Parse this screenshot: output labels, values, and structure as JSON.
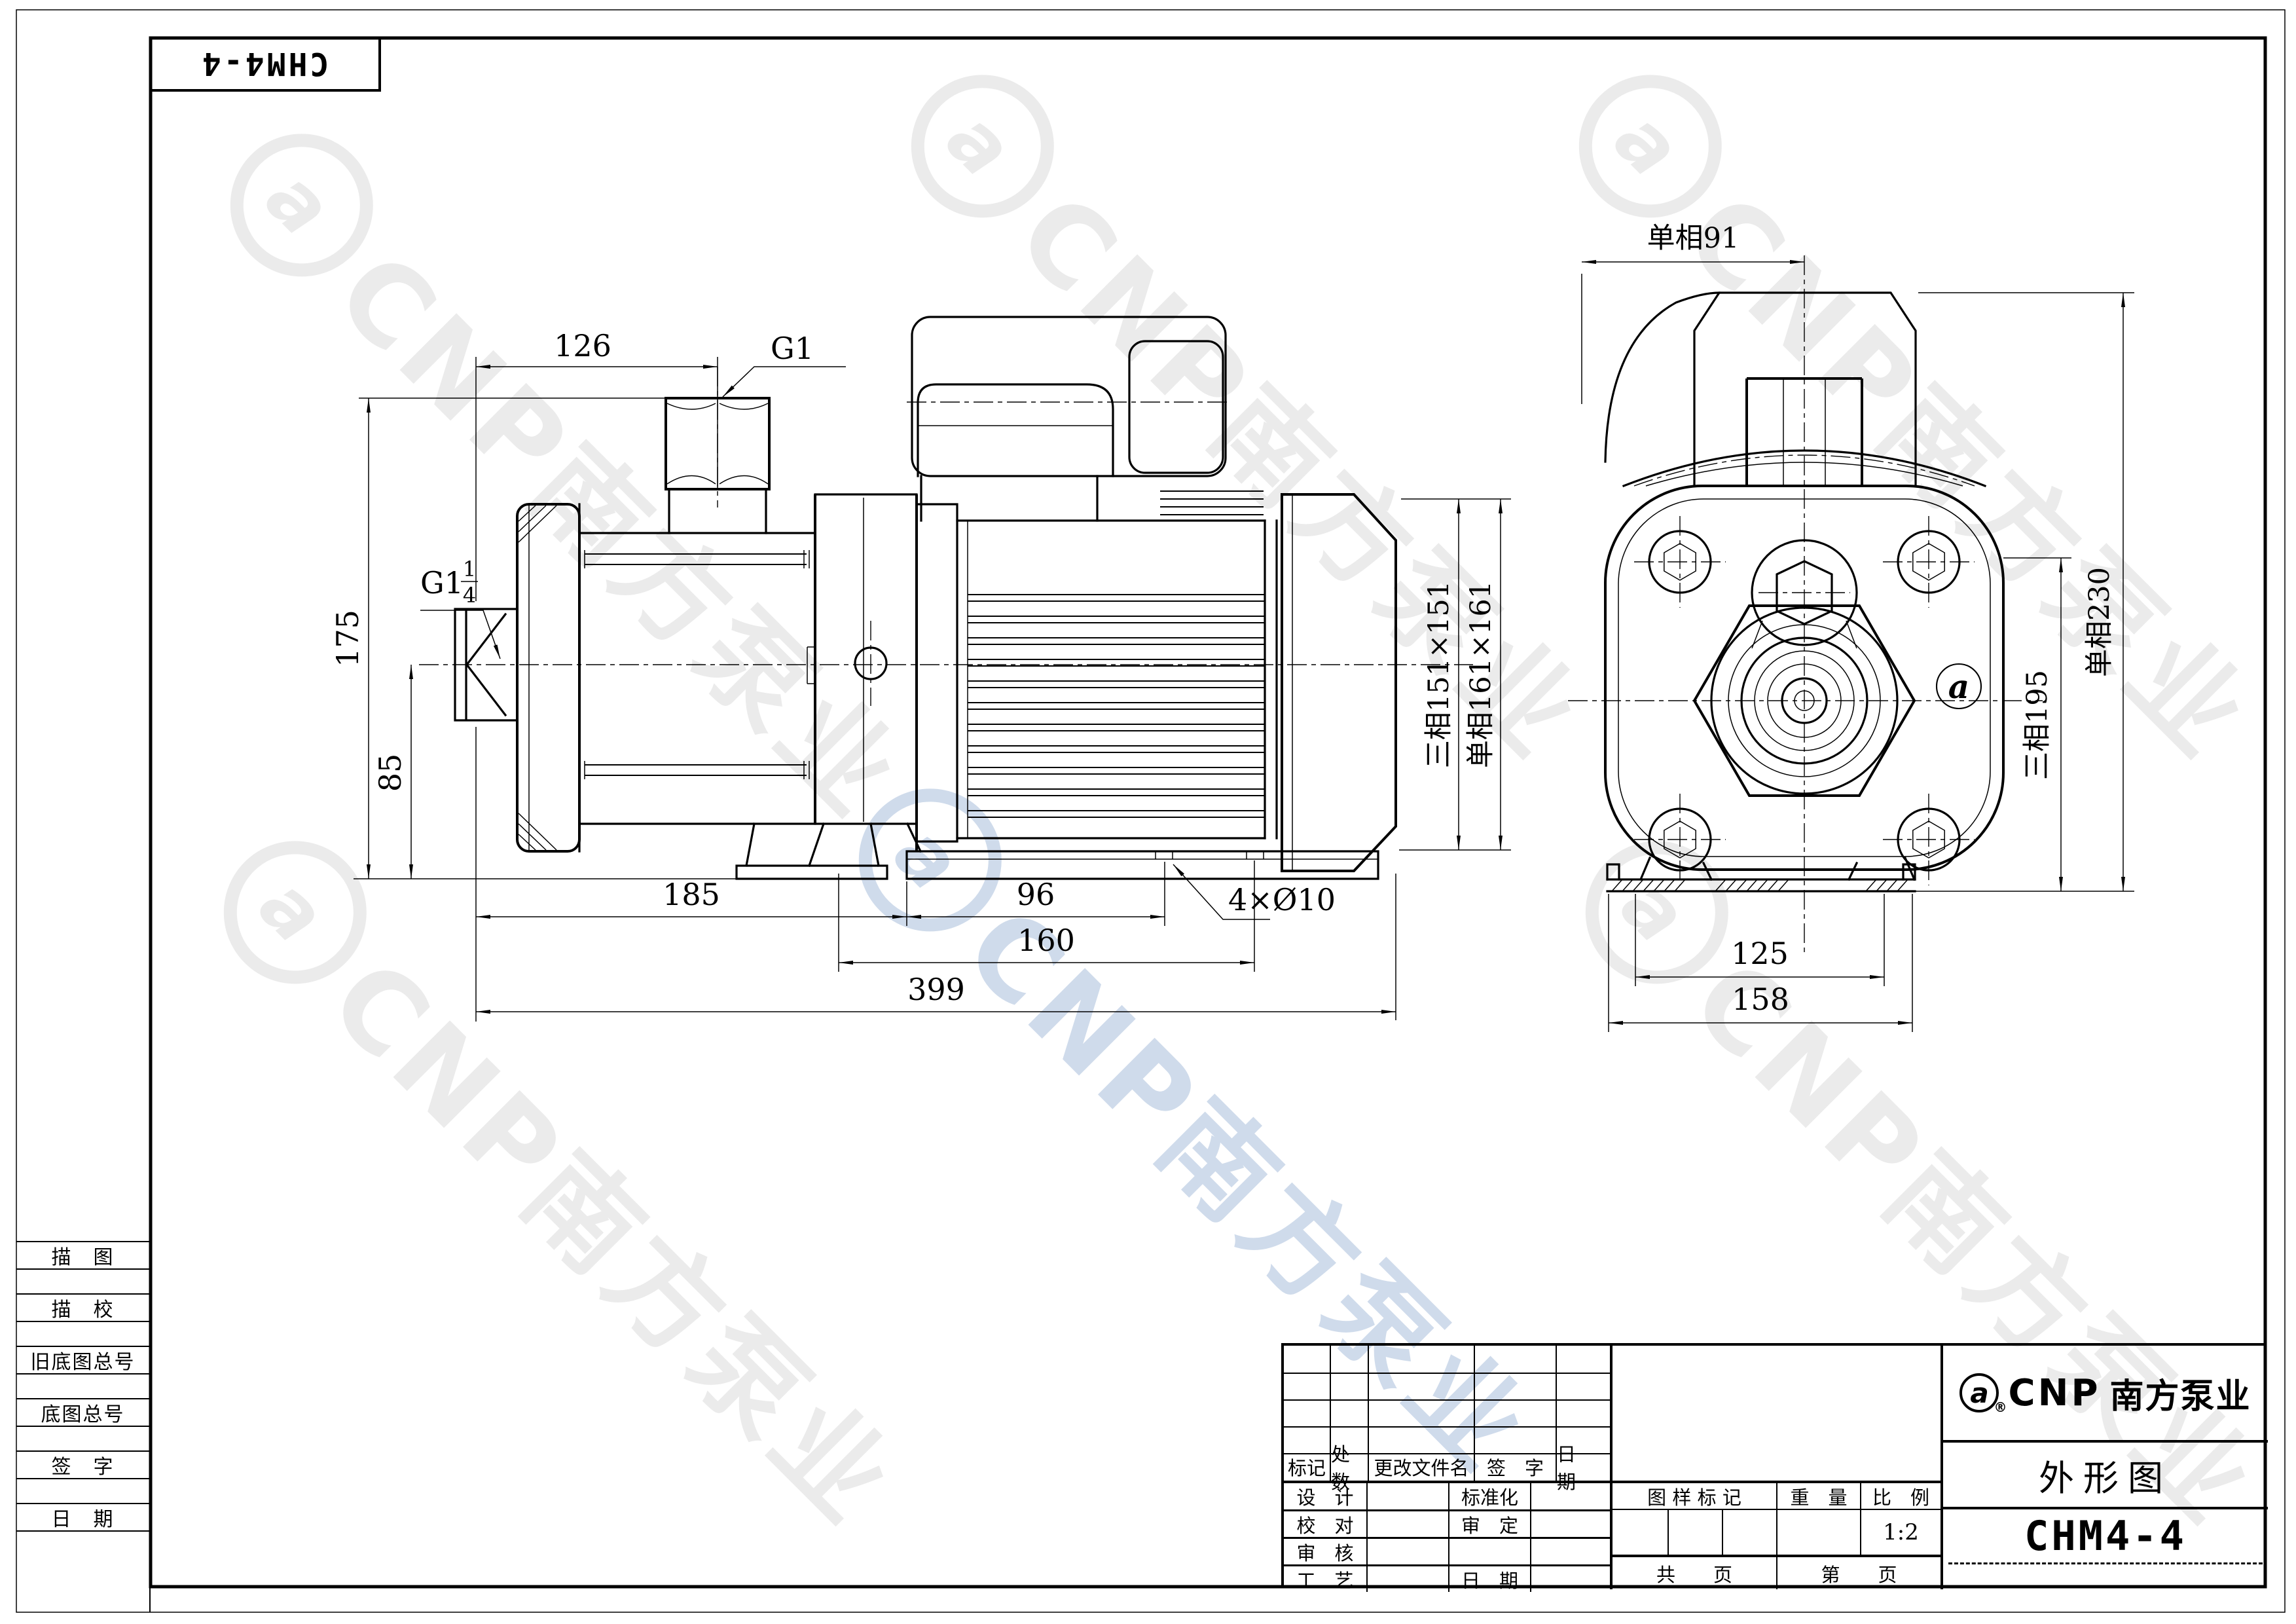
{
  "model": "CHM4-4",
  "watermark": {
    "logo_letter": "a",
    "text": "CNP南方泵业"
  },
  "left_strip": [
    "描　图",
    "描　校",
    "旧底图总号",
    "底图总号",
    "签　字",
    "日　期"
  ],
  "left_view": {
    "d126": "126",
    "g1": "G1",
    "gq_base": "G1",
    "gq_num": "1",
    "gq_den": "4",
    "d175": "175",
    "d85": "85",
    "d185": "185",
    "d96": "96",
    "d160": "160",
    "d399": "399",
    "holes": "4×Ø10",
    "ph3": "三相151×151",
    "ph1": "单相161×161"
  },
  "right_view": {
    "top": "单相91",
    "ph3": "三相195",
    "ph1": "单相230",
    "d125": "125",
    "d158": "158",
    "casing_logo": "a"
  },
  "title_block": {
    "revision_header": [
      "标记",
      "处数",
      "更改文件名",
      "签　字",
      "日　期"
    ],
    "rows": [
      {
        "l": "设　计",
        "r": "标准化"
      },
      {
        "l": "校　对",
        "r": "审　定"
      },
      {
        "l": "审　核",
        "r": ""
      },
      {
        "l": "工　艺",
        "r": "日　期"
      }
    ],
    "stamp_header": [
      "图 样 标 记",
      "重　量",
      "比　例"
    ],
    "scale_value": "1:2",
    "pages_total": "共　　页",
    "pages_no": "第　　页",
    "brand": {
      "logo_letter": "a",
      "reg": "®",
      "cnp": "CNP",
      "name": "南方泵业"
    },
    "doc_title": "外形图"
  }
}
